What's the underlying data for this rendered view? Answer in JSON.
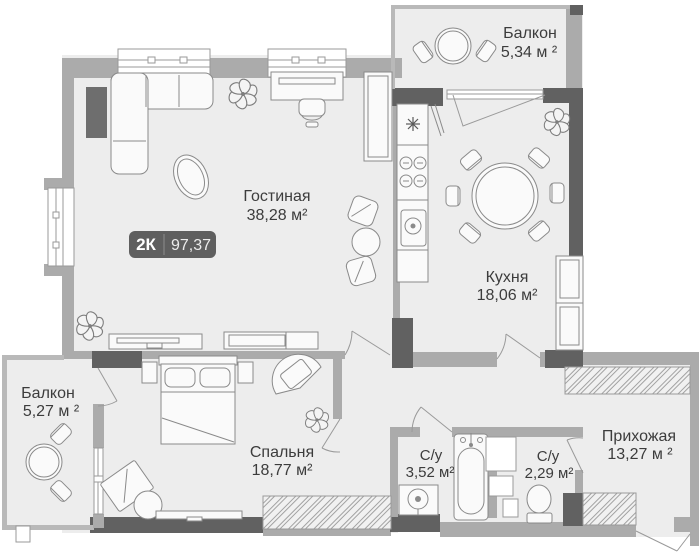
{
  "plan": {
    "badge": {
      "type": "2К",
      "value": "97,37"
    },
    "rooms": {
      "living": {
        "name": "Гостиная",
        "area": "38,28 м²"
      },
      "balcony_top": {
        "name": "Балкон",
        "area": "5,34 м ²"
      },
      "kitchen": {
        "name": "Кухня",
        "area": "18,06 м²"
      },
      "balcony_left": {
        "name": "Балкон",
        "area": "5,27 м ²"
      },
      "bedroom": {
        "name": "Спальня",
        "area": "18,77 м²"
      },
      "bath_1": {
        "name": "С/у",
        "area": "3,52 м²"
      },
      "bath_2": {
        "name": "С/у",
        "area": "2,29 м²"
      },
      "hallway": {
        "name": "Прихожая",
        "area": "13,27 м ²"
      }
    },
    "colors": {
      "wall": "#ababab",
      "wall_dark": "#616161",
      "floor": "#ededed",
      "furniture_line": "#8a8a8a",
      "text": "#3c3c3c",
      "badge_bg": "#5f5f5f"
    }
  }
}
